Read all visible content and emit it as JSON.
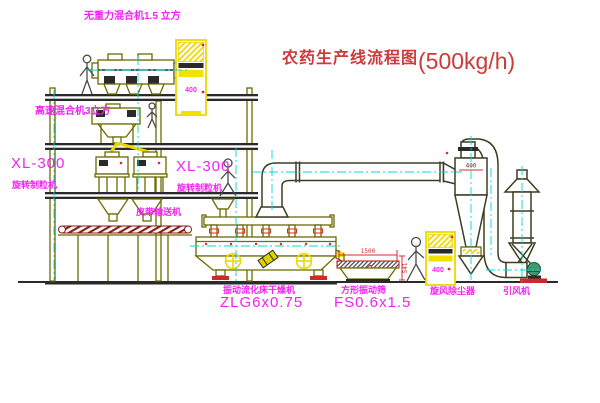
{
  "title": {
    "name": "农药生产线流程图",
    "capacity": "(500kg/h)"
  },
  "equipment_labels": {
    "gravity_free_mixer": "无重力混合机1.5 立方",
    "high_speed_mixer": "高速混合机3立方",
    "granulator_left": {
      "model": "XL-300",
      "name": "旋转制粒机"
    },
    "granulator_right": {
      "model": "XL-300",
      "name": "旋转制粒机"
    },
    "belt_conveyor": "皮带输送机",
    "fluid_bed_dryer": {
      "name": "振动流化床干燥机",
      "model": "ZLG6x0.75"
    },
    "square_sieve": {
      "name": "方形振动筛",
      "model": "FS0.6x1.5"
    },
    "cyclone": "旋风除尘器",
    "induced_draft_fan": "引风机"
  },
  "dimensions": {
    "sieve_length": "1500",
    "sieve_height": "541",
    "cyclone_diameter": "400",
    "cabinet_a": "400",
    "cabinet_b": "400"
  },
  "colors": {
    "line_olive": "#6b6b00",
    "label_magenta": "#f322f3",
    "title_red": "#cd3a3a",
    "accent_yellow": "#f2e000",
    "centerline_cyan": "#00d8d8",
    "accent_red": "#d42e2e",
    "belt_dark_red": "#8b1a1a"
  }
}
